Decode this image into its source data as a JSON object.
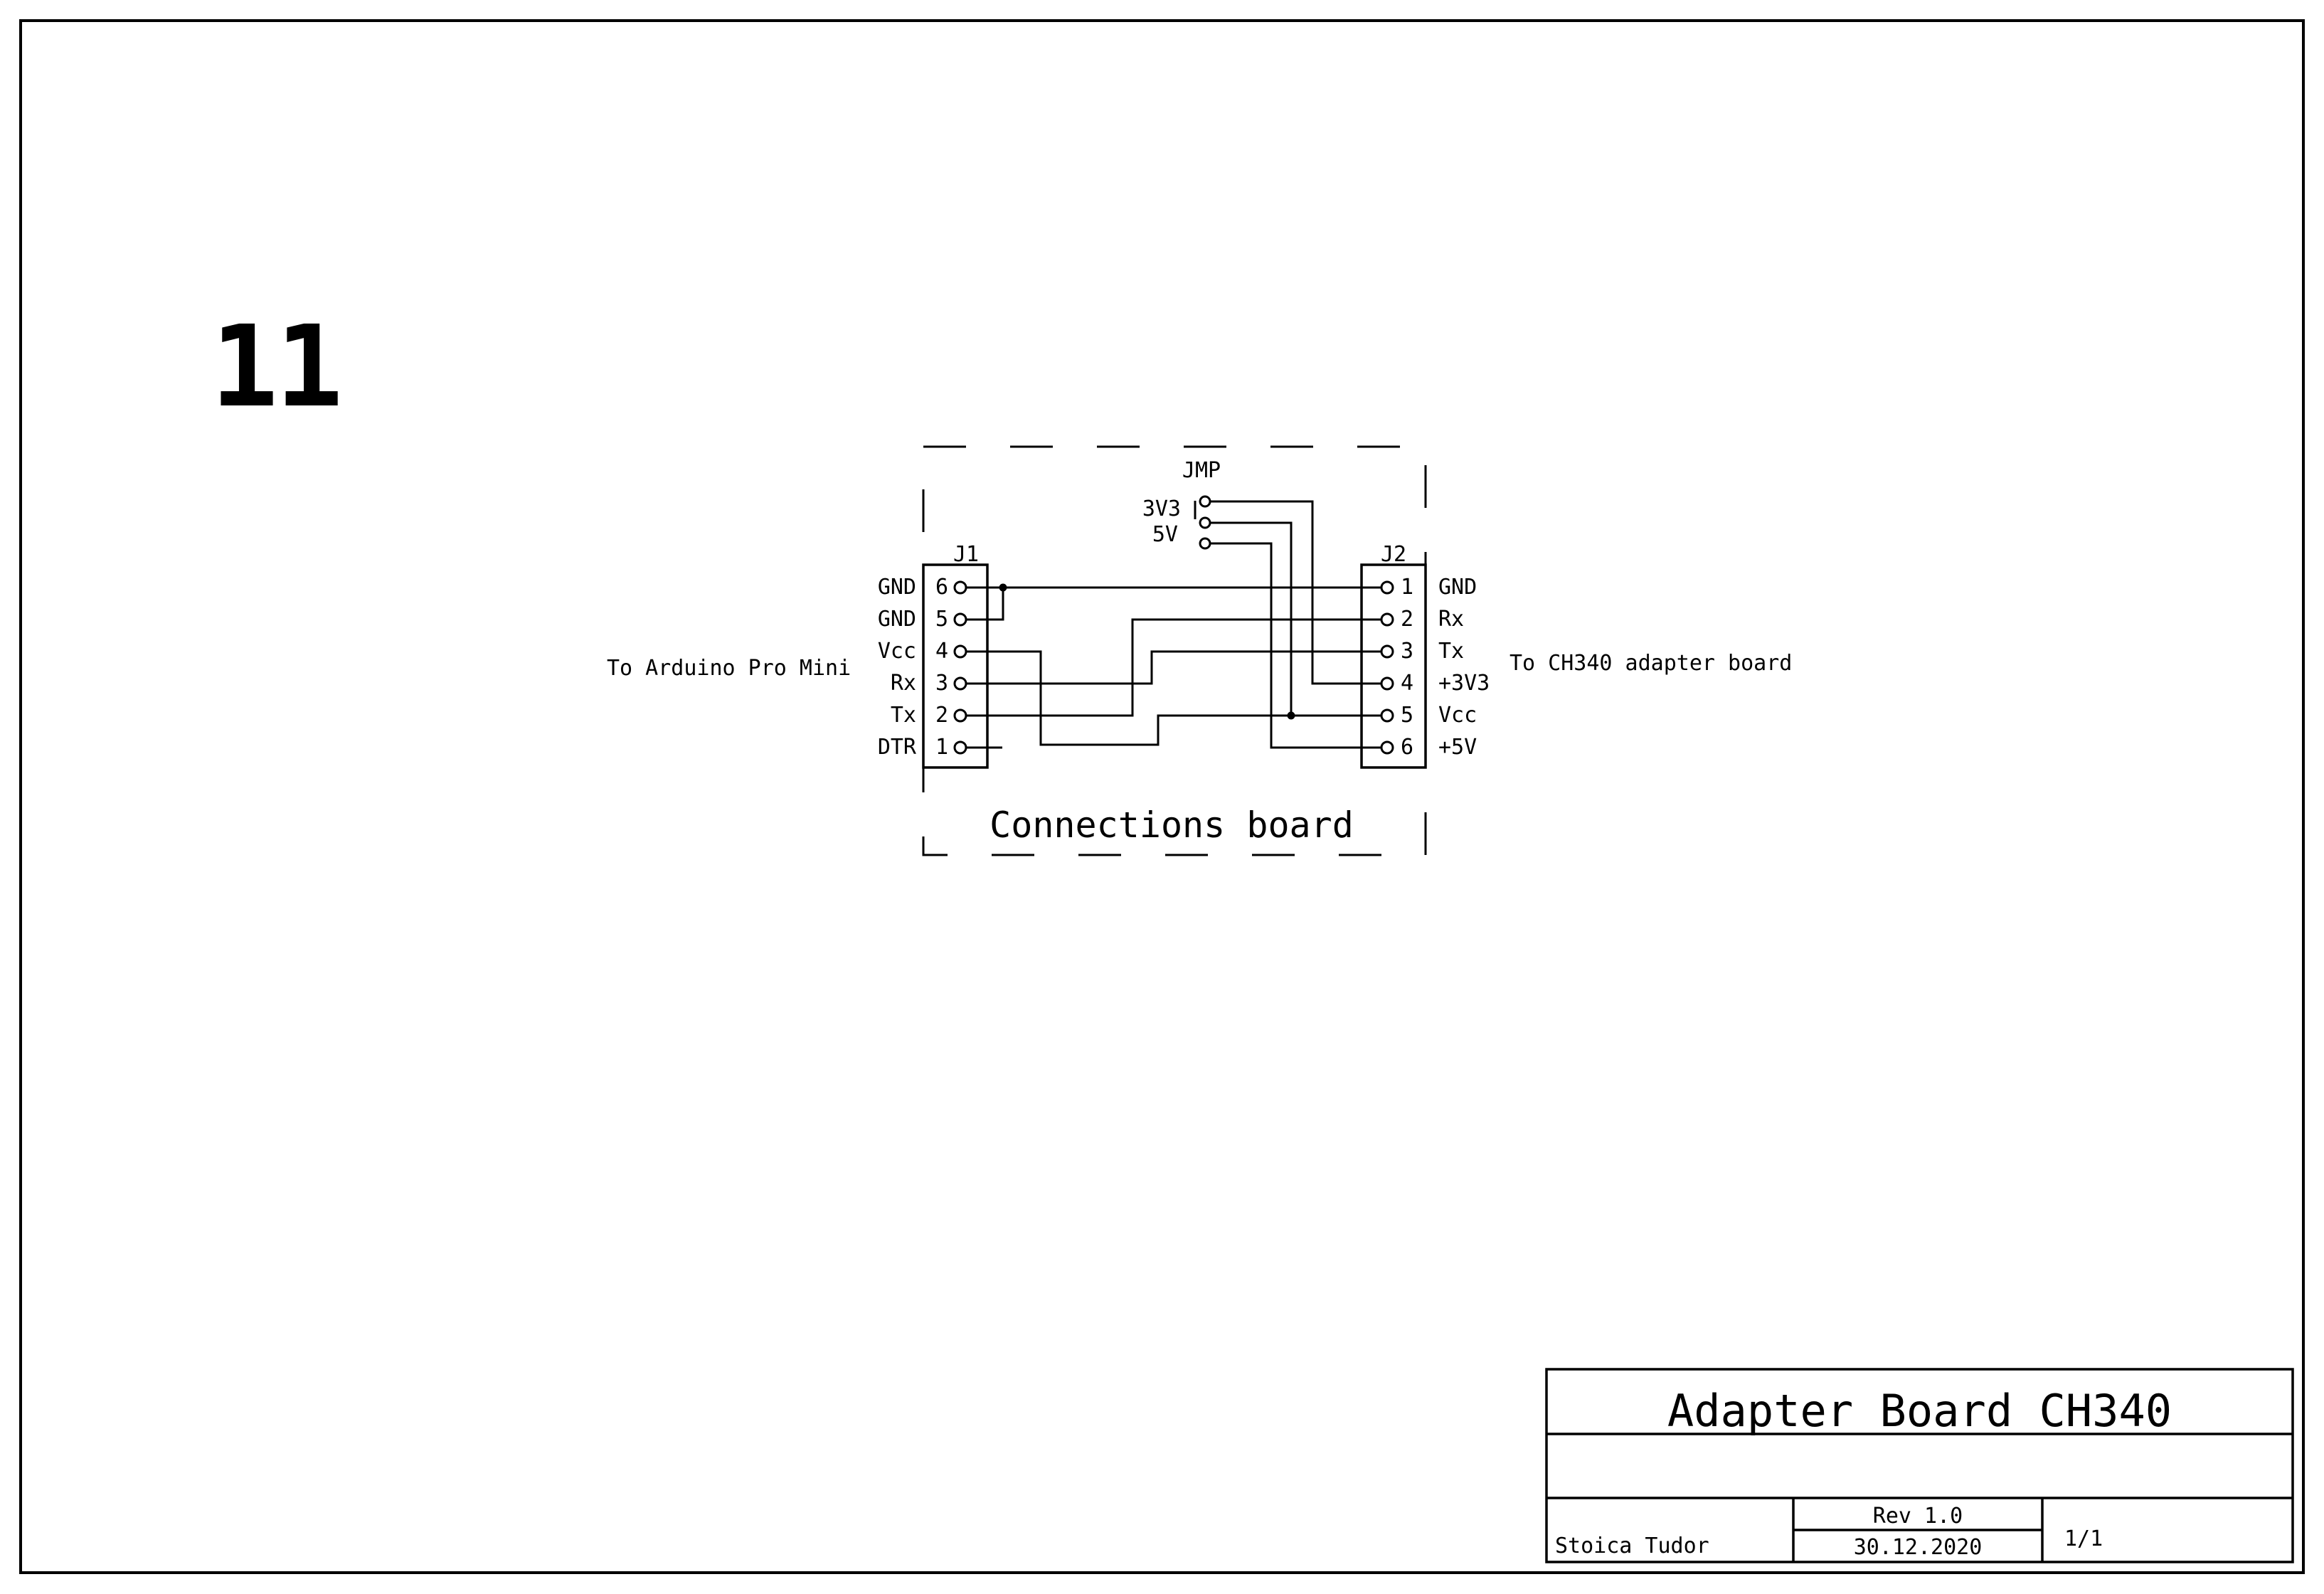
{
  "page": {
    "sheet_number": "11",
    "paper_color": "#ffffff",
    "ink_color": "#000000"
  },
  "schematic": {
    "board_label": "Connections board",
    "left_note": "To Arduino Pro Mini",
    "right_note": "To CH340 adapter board",
    "jumper": {
      "designator": "JMP",
      "option_3v3": "3V3",
      "option_5v": "5V"
    },
    "j1": {
      "designator": "J1",
      "pins": [
        {
          "number": "6",
          "label": "GND"
        },
        {
          "number": "5",
          "label": "GND"
        },
        {
          "number": "4",
          "label": "Vcc"
        },
        {
          "number": "3",
          "label": "Rx"
        },
        {
          "number": "2",
          "label": "Tx"
        },
        {
          "number": "1",
          "label": "DTR"
        }
      ]
    },
    "j2": {
      "designator": "J2",
      "pins": [
        {
          "number": "1",
          "label": "GND"
        },
        {
          "number": "2",
          "label": "Rx"
        },
        {
          "number": "3",
          "label": "Tx"
        },
        {
          "number": "4",
          "label": "+3V3"
        },
        {
          "number": "5",
          "label": "Vcc"
        },
        {
          "number": "6",
          "label": "+5V"
        }
      ]
    }
  },
  "title_block": {
    "title": "Adapter Board CH340",
    "author": "Stoica Tudor",
    "revision": "Rev 1.0",
    "date": "30.12.2020",
    "page_number": "1/1"
  }
}
